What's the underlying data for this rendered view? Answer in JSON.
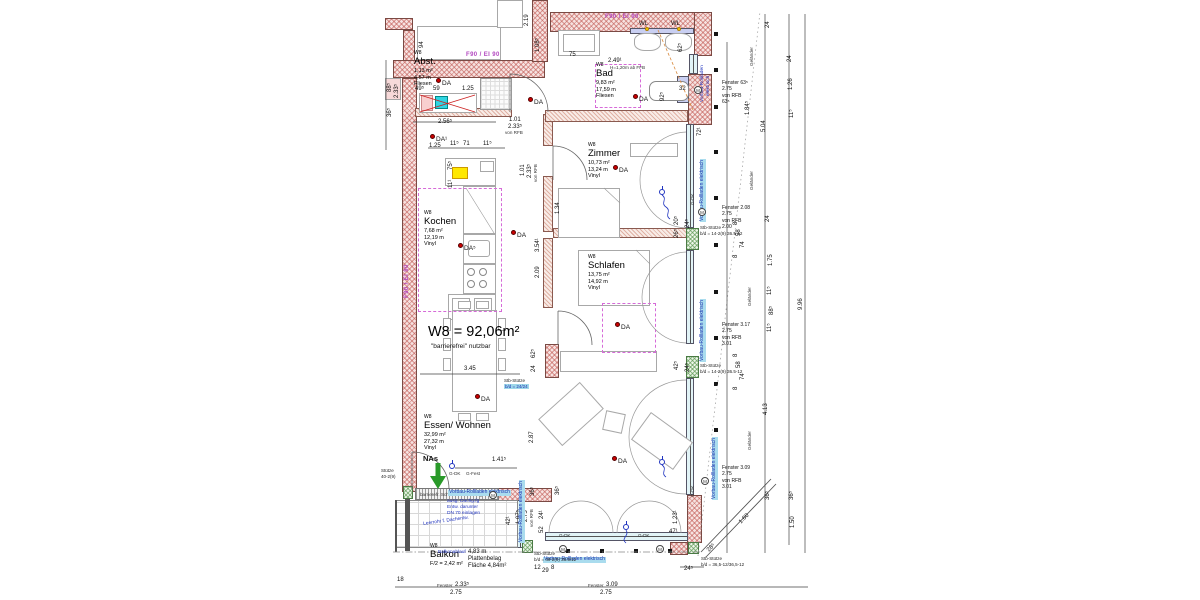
{
  "title": {
    "main": "W8 = 92,06m²",
    "sub": "\"barrierefrei\" nutzbar"
  },
  "rooms": [
    {
      "x": 414,
      "y": 50,
      "tag": "W8",
      "name": "Abst.",
      "area": "1,13 m²",
      "len": "4,57 m",
      "floor": "Fliesen"
    },
    {
      "x": 596,
      "y": 62,
      "tag": "W8",
      "name": "Bad",
      "area": "9,83 m²",
      "len": "17,59 m",
      "floor": "Fliesen"
    },
    {
      "x": 588,
      "y": 142,
      "tag": "W8",
      "name": "Zimmer",
      "area": "10,73 m²",
      "len": "13,24 m",
      "floor": "Vinyl"
    },
    {
      "x": 424,
      "y": 210,
      "tag": "W8",
      "name": "Kochen",
      "area": "7,68 m²",
      "len": "12,19 m",
      "floor": "Vinyl"
    },
    {
      "x": 588,
      "y": 254,
      "tag": "W8",
      "name": "Schlafen",
      "area": "13,75 m²",
      "len": "14,92 m",
      "floor": "Vinyl"
    },
    {
      "x": 424,
      "y": 414,
      "tag": "W8",
      "name": "Essen/ Wohnen",
      "area": "32,99 m²",
      "len": "27,32 m",
      "floor": "Vinyl"
    },
    {
      "x": 430,
      "y": 543,
      "tag": "W8",
      "name": "Balkon",
      "area": "F/2 =  2,42 m²"
    }
  ],
  "da": [
    {
      "x": 436,
      "y": 78,
      "label": "DA"
    },
    {
      "x": 528,
      "y": 97,
      "label": "DA"
    },
    {
      "x": 633,
      "y": 94,
      "label": "DA"
    },
    {
      "x": 430,
      "y": 134,
      "label": "DA¹"
    },
    {
      "x": 511,
      "y": 230,
      "label": "DA"
    },
    {
      "x": 458,
      "y": 243,
      "label": "DA⁵"
    },
    {
      "x": 613,
      "y": 165,
      "label": "DA"
    },
    {
      "x": 615,
      "y": 322,
      "label": "DA"
    },
    {
      "x": 475,
      "y": 394,
      "label": "DA"
    },
    {
      "x": 612,
      "y": 456,
      "label": "DA"
    }
  ],
  "dims": [
    {
      "t": "88⁵",
      "x": 387,
      "y": 92,
      "r": -90
    },
    {
      "t": "2.33⁵",
      "x": 394,
      "y": 98,
      "r": -90
    },
    {
      "t": "36⁵",
      "x": 387,
      "y": 117,
      "r": -90
    },
    {
      "t": "49⁵",
      "x": 415,
      "y": 86
    },
    {
      "t": "59",
      "x": 433,
      "y": 86
    },
    {
      "t": "1.25",
      "x": 462,
      "y": 86
    },
    {
      "t": "2.56⁵",
      "x": 438,
      "y": 119
    },
    {
      "t": "94",
      "x": 419,
      "y": 48,
      "r": -90
    },
    {
      "t": "2.19",
      "x": 524,
      "y": 26,
      "r": -90
    },
    {
      "t": "1.08⁵",
      "x": 535,
      "y": 52,
      "r": -90
    },
    {
      "t": "75",
      "x": 569,
      "y": 52
    },
    {
      "t": "62⁵",
      "x": 678,
      "y": 52,
      "r": -90
    },
    {
      "t": "72¹",
      "x": 697,
      "y": 136,
      "r": -90
    },
    {
      "t": "92⁵",
      "x": 660,
      "y": 101,
      "r": -90
    },
    {
      "t": "32",
      "x": 679,
      "y": 86
    },
    {
      "t": "WL",
      "x": 639,
      "y": 21
    },
    {
      "t": "WL",
      "x": 671,
      "y": 21
    },
    {
      "t": "2.49¹",
      "x": 608,
      "y": 58
    },
    {
      "t": "H=1,20m ab FFB",
      "x": 610,
      "y": 66,
      "cls": "xs"
    },
    {
      "t": "1.01",
      "x": 509,
      "y": 117
    },
    {
      "t": "2.33⁵",
      "x": 508,
      "y": 124
    },
    {
      "t": "von RFB",
      "x": 505,
      "y": 131,
      "cls": "xs"
    },
    {
      "t": "1.25",
      "x": 429,
      "y": 143
    },
    {
      "t": "11⁵",
      "x": 450,
      "y": 141
    },
    {
      "t": "71",
      "x": 463,
      "y": 141
    },
    {
      "t": "11⁵",
      "x": 483,
      "y": 141
    },
    {
      "t": "75⁵",
      "x": 448,
      "y": 170,
      "r": -90
    },
    {
      "t": "11¹",
      "x": 448,
      "y": 188,
      "r": -90
    },
    {
      "t": "1.01",
      "x": 520,
      "y": 176,
      "r": -90
    },
    {
      "t": "2.33⁵",
      "x": 527,
      "y": 178,
      "r": -90
    },
    {
      "t": "von RFB",
      "x": 534,
      "y": 182,
      "r": -90,
      "cls": "xs"
    },
    {
      "t": "3.54¹",
      "x": 535,
      "y": 252,
      "r": -90
    },
    {
      "t": "1.34",
      "x": 555,
      "y": 214,
      "r": -90
    },
    {
      "t": "2.09",
      "x": 535,
      "y": 278,
      "r": -90
    },
    {
      "t": "62⁵",
      "x": 531,
      "y": 358,
      "r": -90
    },
    {
      "t": "24",
      "x": 531,
      "y": 372,
      "r": -90
    },
    {
      "t": "3.45",
      "x": 464,
      "y": 366
    },
    {
      "t": "1.41⁵",
      "x": 492,
      "y": 457
    },
    {
      "t": "2.87",
      "x": 529,
      "y": 443,
      "r": -90
    },
    {
      "t": "36⁵",
      "x": 530,
      "y": 496,
      "r": -90
    },
    {
      "t": "42¹",
      "x": 506,
      "y": 525,
      "r": -90
    },
    {
      "t": "1.07⁵",
      "x": 516,
      "y": 524,
      "r": -90
    },
    {
      "t": "2.75",
      "x": 523,
      "y": 522,
      "r": -90
    },
    {
      "t": "von RFB",
      "x": 530,
      "y": 527,
      "r": -90,
      "cls": "xs"
    },
    {
      "t": "24¹",
      "x": 539,
      "y": 519,
      "r": -90
    },
    {
      "t": "52",
      "x": 539,
      "y": 533,
      "r": -90
    },
    {
      "t": "12",
      "x": 534,
      "y": 565
    },
    {
      "t": "29",
      "x": 542,
      "y": 568
    },
    {
      "t": "8",
      "x": 551,
      "y": 565
    },
    {
      "t": "18",
      "x": 397,
      "y": 577
    },
    {
      "t": "Fenster",
      "x": 437,
      "y": 584,
      "cls": "xs"
    },
    {
      "t": "2.33⁵",
      "x": 455,
      "y": 582
    },
    {
      "t": "2.75",
      "x": 450,
      "y": 590
    },
    {
      "t": "Fenster",
      "x": 588,
      "y": 584,
      "cls": "xs"
    },
    {
      "t": "3.09",
      "x": 606,
      "y": 582
    },
    {
      "t": "2.75",
      "x": 600,
      "y": 590
    },
    {
      "t": "24⁵",
      "x": 684,
      "y": 566
    },
    {
      "t": "47¹",
      "x": 669,
      "y": 529
    },
    {
      "t": "1.23¹",
      "x": 673,
      "y": 524,
      "r": -90
    },
    {
      "t": "28⁵",
      "x": 706,
      "y": 549,
      "r": -45
    },
    {
      "t": "1.60",
      "x": 738,
      "y": 521,
      "r": -45
    },
    {
      "t": "G-DK",
      "x": 449,
      "y": 472,
      "cls": "xs"
    },
    {
      "t": "G-Fest",
      "x": 466,
      "y": 472,
      "cls": "xs"
    },
    {
      "t": "G-DK",
      "x": 559,
      "y": 534,
      "cls": "xs"
    },
    {
      "t": "G-DK",
      "x": 638,
      "y": 534,
      "cls": "xs"
    },
    {
      "t": "G-DK",
      "x": 691,
      "y": 497,
      "r": -90,
      "cls": "xs"
    },
    {
      "t": "G-DK",
      "x": 691,
      "y": 205,
      "r": -90,
      "cls": "xs"
    },
    {
      "t": "barrierefr. Schwelle",
      "x": 420,
      "y": 493,
      "cls": "xs"
    },
    {
      "t": "Entwässerungsrinne",
      "x": 453,
      "y": 493,
      "cls": "xs"
    },
    {
      "t": "20⁵",
      "x": 674,
      "y": 225,
      "r": -90
    },
    {
      "t": "26⁵",
      "x": 674,
      "y": 238,
      "r": -90
    },
    {
      "t": "24⁵",
      "x": 685,
      "y": 228,
      "r": -90
    },
    {
      "t": "42⁵",
      "x": 674,
      "y": 370,
      "r": -90
    },
    {
      "t": "24⁵",
      "x": 685,
      "y": 372,
      "r": -90
    },
    {
      "t": "8",
      "x": 733,
      "y": 357,
      "r": -90
    },
    {
      "t": "58",
      "x": 736,
      "y": 368,
      "r": -90
    },
    {
      "t": "74",
      "x": 740,
      "y": 380,
      "r": -90
    },
    {
      "t": "8",
      "x": 733,
      "y": 390,
      "r": -90
    },
    {
      "t": "8",
      "x": 733,
      "y": 225,
      "r": -90
    },
    {
      "t": "58",
      "x": 736,
      "y": 236,
      "r": -90
    },
    {
      "t": "74",
      "x": 740,
      "y": 248,
      "r": -90
    },
    {
      "t": "8",
      "x": 733,
      "y": 258,
      "r": -90
    },
    {
      "t": "1.84⁵",
      "x": 745,
      "y": 115,
      "r": -90
    },
    {
      "t": "5.04",
      "x": 761,
      "y": 132,
      "r": -90
    },
    {
      "t": "24",
      "x": 765,
      "y": 222,
      "r": -90
    },
    {
      "t": "1.75",
      "x": 768,
      "y": 266,
      "r": -90
    },
    {
      "t": "11⁵",
      "x": 767,
      "y": 295,
      "r": -90
    },
    {
      "t": "88⁵",
      "x": 769,
      "y": 315,
      "r": -90
    },
    {
      "t": "11⁵",
      "x": 767,
      "y": 332,
      "r": -90
    },
    {
      "t": "4.13",
      "x": 763,
      "y": 415,
      "r": -90
    },
    {
      "t": "36⁵",
      "x": 765,
      "y": 500,
      "r": -90
    },
    {
      "t": "24",
      "x": 765,
      "y": 28,
      "r": -90
    },
    {
      "t": "24",
      "x": 787,
      "y": 62,
      "r": -90
    },
    {
      "t": "1.26",
      "x": 788,
      "y": 90,
      "r": -90
    },
    {
      "t": "11⁵",
      "x": 789,
      "y": 118,
      "r": -90
    },
    {
      "t": "36⁵",
      "x": 789,
      "y": 500,
      "r": -90
    },
    {
      "t": "1.50",
      "x": 790,
      "y": 528,
      "r": -90
    },
    {
      "t": "9.96",
      "x": 798,
      "y": 310,
      "r": -90
    },
    {
      "t": "Geländer",
      "x": 750,
      "y": 66,
      "r": -90,
      "cls": "xs"
    },
    {
      "t": "Geländer",
      "x": 750,
      "y": 190,
      "r": -90,
      "cls": "xs"
    },
    {
      "t": "Geländer",
      "x": 748,
      "y": 306,
      "r": -90,
      "cls": "xs"
    },
    {
      "t": "Geländer",
      "x": 748,
      "y": 450,
      "r": -90,
      "cls": "xs"
    },
    {
      "t": "4,83 m",
      "x": 468,
      "y": 549
    },
    {
      "t": "Plattenbelag",
      "x": 468,
      "y": 556
    },
    {
      "t": "Fläche 4,84m²",
      "x": 468,
      "y": 563
    },
    {
      "t": "36⁵",
      "x": 555,
      "y": 495,
      "r": -90
    },
    {
      "t": "NAs",
      "x": 423,
      "y": 455,
      "cls": "md"
    }
  ],
  "window_blocks": [
    {
      "x": 722,
      "y": 80,
      "lines": [
        "Fenster 63⁵",
        "2.75",
        "von RFB",
        "63⁵"
      ]
    },
    {
      "x": 722,
      "y": 205,
      "lines": [
        "Fenster 2.08",
        "2.75",
        "von RFB",
        "2.00"
      ]
    },
    {
      "x": 722,
      "y": 322,
      "lines": [
        "Fenster 3.17",
        "2.75",
        "von RFB",
        "3.01"
      ]
    },
    {
      "x": 722,
      "y": 465,
      "lines": [
        "Fenster 3.09",
        "2.75",
        "von RFB",
        "3.01"
      ]
    }
  ],
  "chips": [
    {
      "t": "Vorbau-Rollladen elektrisch",
      "x": 700,
      "y": 222,
      "r": -90
    },
    {
      "t": "Vorbau-Rollladen elektrisch",
      "x": 700,
      "y": 362,
      "r": -90
    },
    {
      "t": "Vorbau-Rollladen elektrisch",
      "x": 712,
      "y": 500,
      "r": -90
    },
    {
      "t": "Vorbau-Rollladen elektrisch",
      "x": 543,
      "y": 557
    },
    {
      "t": "Vorbau-Rollladen elektrisch",
      "x": 448,
      "y": 490
    },
    {
      "t": "Vorbau-Rollladen elektrisch",
      "x": 519,
      "y": 543,
      "r": -90
    }
  ],
  "blue": [
    {
      "t": "ausg. Dachg.fg",
      "x": 447,
      "y": 499
    },
    {
      "t": "Entw. darunter",
      "x": 447,
      "y": 505
    },
    {
      "t": "DN 70 einlagen",
      "x": 447,
      "y": 511
    },
    {
      "t": "Leerrohr f. Dachentw.",
      "x": 423,
      "y": 522,
      "r": -8
    },
    {
      "t": "Balkonablauf",
      "x": 438,
      "y": 550
    },
    {
      "t": "Vorbau-Rollladen",
      "x": 700,
      "y": 102,
      "r": -90
    },
    {
      "t": "elektrisch",
      "x": 706,
      "y": 96,
      "r": -90
    }
  ],
  "fire": [
    {
      "t": "F90 / EI 90",
      "x": 605,
      "y": 14
    },
    {
      "t": "F90 / EI 90",
      "x": 466,
      "y": 52
    },
    {
      "t": "F90 / EI 90",
      "x": 404,
      "y": 298,
      "r": -90
    }
  ],
  "stb": [
    {
      "x": 504,
      "y": 378,
      "cls": "chip2",
      "lines": [
        "Stb-Stütze",
        "b/d = 24/24"
      ]
    },
    {
      "x": 700,
      "y": 225,
      "lines": [
        "Stb-Stütze",
        "b/d = 14-2(9) 36.5-12"
      ]
    },
    {
      "x": 700,
      "y": 363,
      "lines": [
        "Stb-Stütze",
        "b/d = 14-2(9) 36.5-12"
      ]
    },
    {
      "x": 534,
      "y": 551,
      "lines": [
        "Stb-Stütze",
        "b/d = 49-2(9) 36.5/12"
      ]
    },
    {
      "x": 701,
      "y": 556,
      "lines": [
        "Stb-Stütze",
        "b/d = 36,5-12/36,5-12"
      ]
    },
    {
      "x": 381,
      "y": 468,
      "lines": [
        "Stütze",
        "40-2(9)"
      ]
    }
  ],
  "circles_m": [
    {
      "x": 694,
      "y": 86,
      "label": "M"
    },
    {
      "x": 698,
      "y": 208,
      "label": "M"
    },
    {
      "x": 701,
      "y": 477,
      "label": "M"
    },
    {
      "x": 559,
      "y": 545,
      "label": "M"
    },
    {
      "x": 656,
      "y": 545,
      "label": "M"
    },
    {
      "x": 489,
      "y": 491,
      "label": "M"
    }
  ],
  "circles_e": [
    {
      "x": 659,
      "y": 189
    },
    {
      "x": 659,
      "y": 459
    },
    {
      "x": 623,
      "y": 524
    },
    {
      "x": 449,
      "y": 463
    }
  ]
}
